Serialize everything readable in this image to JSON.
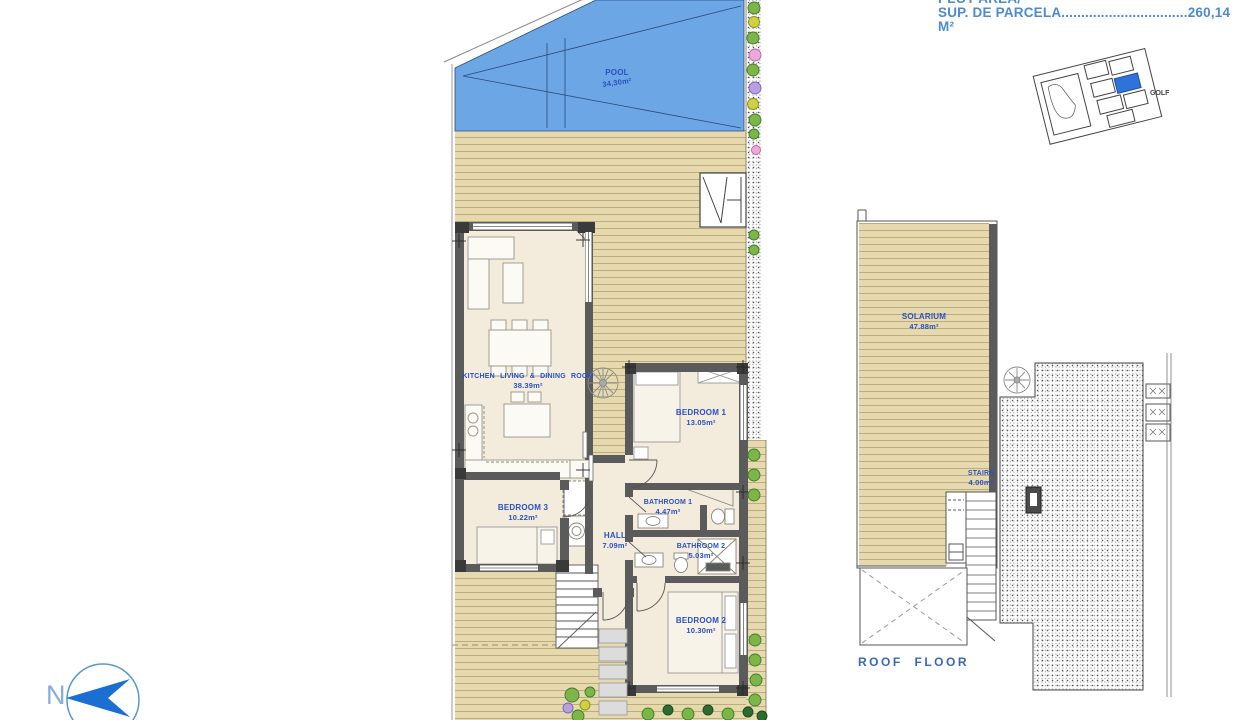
{
  "header": {
    "plot_area_title": "PLOT AREA/",
    "plot_area_label": "SUP. DE PARCELA",
    "plot_area_leader": "................................",
    "plot_area_value": "260,14 M²"
  },
  "site_map": {
    "golf_label": "GOLF"
  },
  "ground_floor": {
    "pool": {
      "name": "POOL",
      "area": "34,30m²"
    },
    "kitchen_living_dining": {
      "name": "KITCHEN LIVING & DINING ROOM",
      "area": "38.39m²"
    },
    "bedroom_1": {
      "name": "BEDROOM 1",
      "area": "13.05m²"
    },
    "bedroom_2": {
      "name": "BEDROOM 2",
      "area": "10.30m²"
    },
    "bedroom_3": {
      "name": "BEDROOM 3",
      "area": "10.22m²"
    },
    "bathroom_1": {
      "name": "BATHROOM 1",
      "area": "4.47m²"
    },
    "bathroom_2": {
      "name": "BATHROOM 2",
      "area": "5.03m²"
    },
    "hall": {
      "name": "HALL",
      "area": "7.09m²"
    }
  },
  "roof_floor": {
    "title": "ROOF FLOOR",
    "solarium": {
      "name": "SOLARIUM",
      "area": "47.88m²"
    },
    "stairs": {
      "name": "STAIRS",
      "area": "4.00m²"
    }
  },
  "compass": {
    "north": "N"
  },
  "colors": {
    "pool_blue": "#6ca6e4",
    "deck_tan": "#e6d9ad",
    "floor_cream": "#f3ecdc",
    "wall_gray": "#5b5b5b",
    "label_blue": "#2b50c0",
    "annotation_blue": "#4d8ace",
    "site_highlight_blue": "#2f72d9"
  }
}
